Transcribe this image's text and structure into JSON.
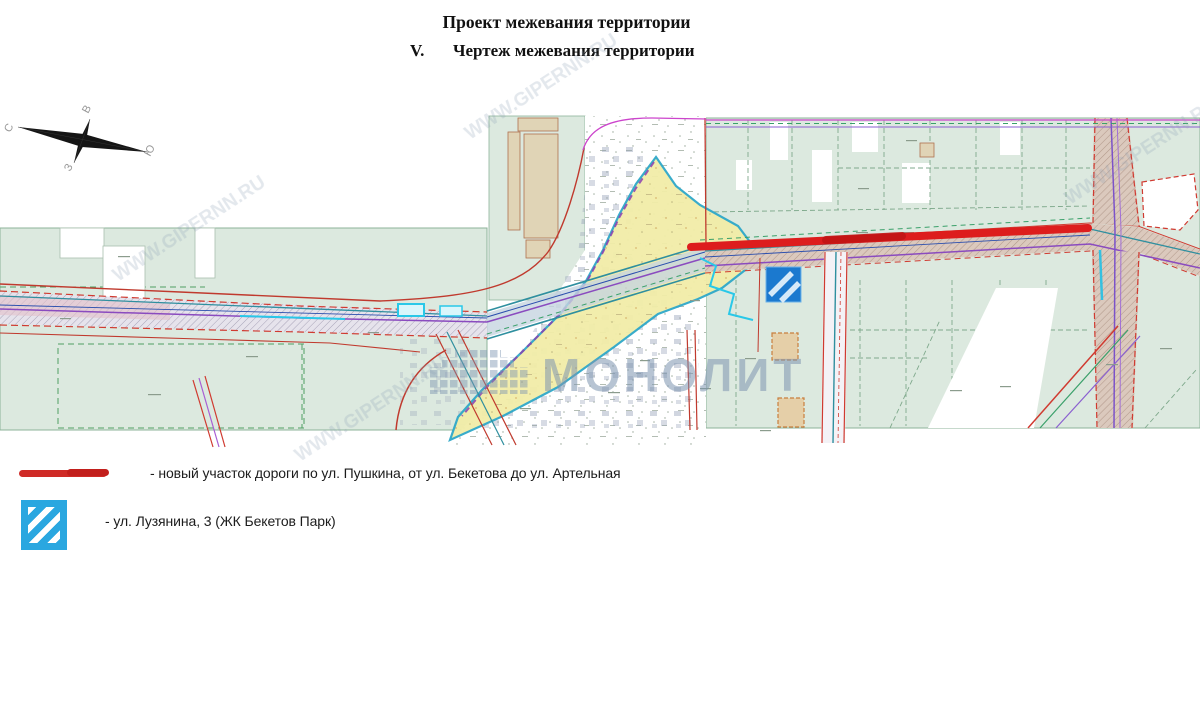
{
  "title": {
    "line1": "Проект межевания территории",
    "line2_num": "V.",
    "line2": "Чертеж межевания территории"
  },
  "compass": {
    "north": "С",
    "south": "Ю",
    "east": "В",
    "west": "З"
  },
  "watermarks": {
    "brand": "МОНОЛИТ",
    "site": "WWW.GIPERNN.RU"
  },
  "legend": {
    "items": [
      {
        "symbol": "red-line",
        "color": "#cf2b27",
        "label": "- новый участок дороги по ул. Пушкина, от ул. Бекетова до ул. Артельная"
      },
      {
        "symbol": "blue-hatched-square",
        "color": "#2aa7e0",
        "label": "- ул. Лузянина, 3 (ЖК Бекетов Парк)"
      }
    ]
  },
  "map": {
    "colors": {
      "parcel_green": "#dce9df",
      "survey_yellow": "#f2eda8",
      "new_road_red": "#dd1d1d",
      "marker_blue": "#1b79cf",
      "cadastral_red": "#c03a2e",
      "utility_cyan": "#29c8e8",
      "boundary_magenta": "#cc44cc",
      "road_violet": "#8a4bbf",
      "watermark_blue": "#7e95b0"
    }
  }
}
